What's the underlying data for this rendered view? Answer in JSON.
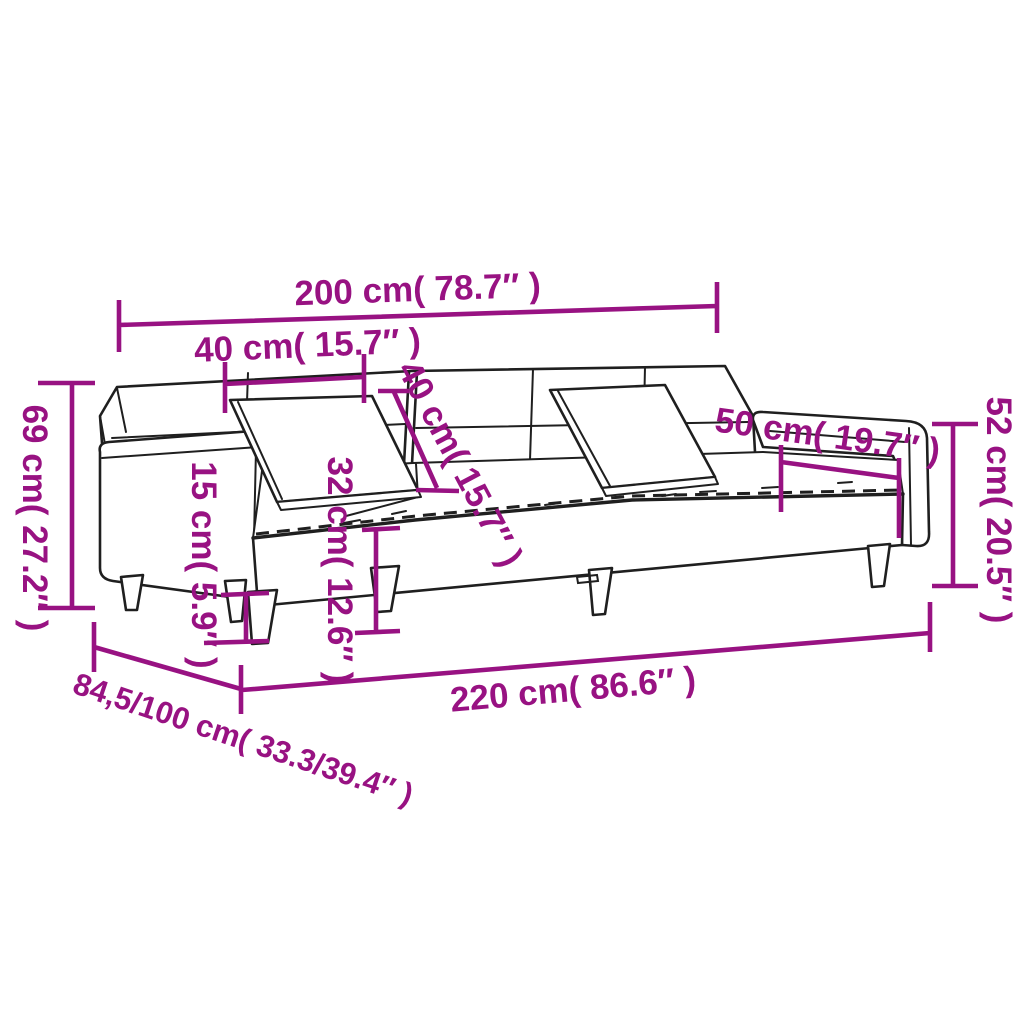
{
  "figure": {
    "type": "product-dimension-diagram",
    "subject": "two-seater sofa bed with two pillows, line drawing with measurements"
  },
  "colors": {
    "dimension_annotation": "#981282",
    "drawing_outline": "#1f1f1f",
    "background": "#ffffff"
  },
  "labels": {
    "back_width": "200 cm( 78.7″ )",
    "back_cushion_width": "40 cm( 15.7″ )",
    "back_cushion_diagonal": "40 cm( 15.7″ )",
    "total_height": "69 cm( 27.2″ )",
    "seat_height": "32 cm( 12.6″ )",
    "leg_height": "15 cm( 5.9″ )",
    "armrest_length": "50 cm( 19.7″ )",
    "armrest_height": "52 cm( 20.5″ )",
    "total_width": "220 cm( 86.6″ )",
    "depth": "84,5/100 cm( 33.3/39.4″ )"
  }
}
